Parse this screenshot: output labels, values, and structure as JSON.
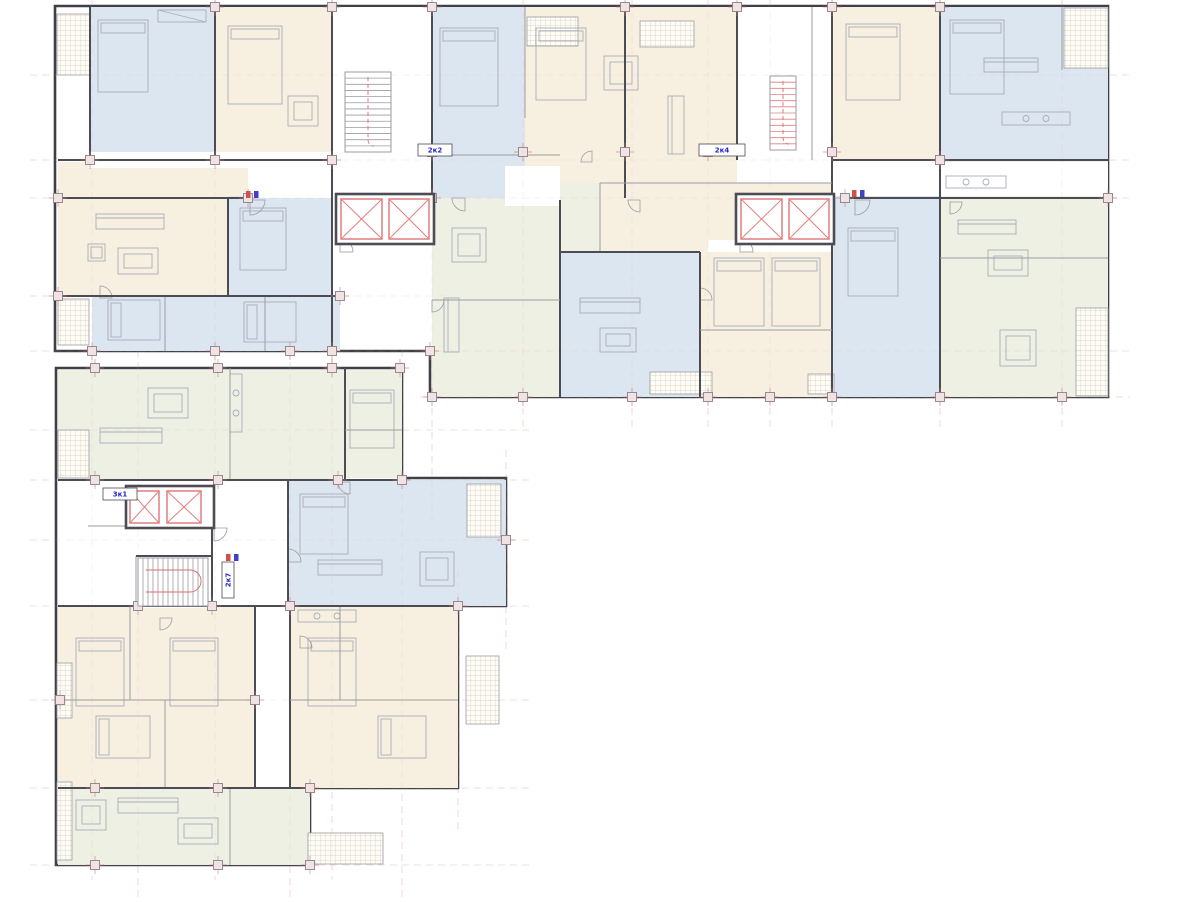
{
  "document": {
    "type": "architectural-floor-plan",
    "description": "Residential building floor plan, L-shaped, two wings with apartments, elevator cores and stairwells"
  },
  "palette": {
    "background": "#ffffff",
    "blue": "#dce6f0",
    "cream": "#f7f0e1",
    "green": "#edf0e3",
    "wall_dark": "#4c4c55",
    "wall_light": "#9b9ba3",
    "outline": "#3f3f47",
    "red_accent": "#e07f7f",
    "red_line": "#d96a6a",
    "column_fill": "#f2e2e2",
    "grid_pink": "#dba8a8",
    "hatch_line": "#d6ccb4",
    "furniture_line": "#a9adb8",
    "label_blue": "#2525cf",
    "meter_red": "#d05050",
    "meter_blue": "#4040c8"
  },
  "labels": [
    {
      "text": "2к2",
      "x": 418,
      "y": 144,
      "w": 34,
      "h": 12,
      "vertical": false
    },
    {
      "text": "2к4",
      "x": 699,
      "y": 144,
      "w": 46,
      "h": 12,
      "vertical": false
    },
    {
      "text": "3к1",
      "x": 103,
      "y": 488,
      "w": 34,
      "h": 12,
      "vertical": false
    },
    {
      "text": "2к7",
      "x": 222,
      "y": 562,
      "w": 12,
      "h": 36,
      "vertical": true
    }
  ],
  "footprints": [
    {
      "id": "upper-wing",
      "points": [
        [
          55,
          6
        ],
        [
          1108,
          6
        ],
        [
          1108,
          397
        ],
        [
          430,
          397
        ],
        [
          430,
          351
        ],
        [
          55,
          351
        ]
      ]
    },
    {
      "id": "lower-wing",
      "points": [
        [
          56,
          368
        ],
        [
          402,
          368
        ],
        [
          402,
          478
        ],
        [
          506,
          478
        ],
        [
          506,
          606
        ],
        [
          458,
          606
        ],
        [
          458,
          788
        ],
        [
          310,
          788
        ],
        [
          310,
          865
        ],
        [
          56,
          865
        ]
      ]
    }
  ],
  "zones": [
    [
      90,
      7,
      125,
      153,
      "blue"
    ],
    [
      215,
      7,
      117,
      153,
      "cream"
    ],
    [
      432,
      7,
      93,
      191,
      "blue"
    ],
    [
      525,
      7,
      100,
      191,
      "cream"
    ],
    [
      625,
      7,
      112,
      193,
      "cream"
    ],
    [
      832,
      7,
      108,
      153,
      "cream"
    ],
    [
      940,
      7,
      168,
      153,
      "blue"
    ],
    [
      58,
      162,
      230,
      134,
      "cream"
    ],
    [
      92,
      296,
      248,
      55,
      "blue"
    ],
    [
      228,
      196,
      104,
      100,
      "blue"
    ],
    [
      432,
      198,
      128,
      199,
      "green"
    ],
    [
      600,
      183,
      108,
      69,
      "cream"
    ],
    [
      708,
      183,
      124,
      57,
      "cream"
    ],
    [
      560,
      183,
      40,
      69,
      "green"
    ],
    [
      560,
      252,
      140,
      145,
      "blue"
    ],
    [
      700,
      252,
      132,
      145,
      "cream"
    ],
    [
      832,
      196,
      108,
      201,
      "blue"
    ],
    [
      940,
      160,
      168,
      237,
      "green"
    ],
    [
      58,
      370,
      287,
      110,
      "green"
    ],
    [
      345,
      370,
      57,
      108,
      "green"
    ],
    [
      288,
      480,
      218,
      126,
      "blue"
    ],
    [
      58,
      606,
      197,
      182,
      "cream"
    ],
    [
      290,
      606,
      168,
      182,
      "cream"
    ],
    [
      58,
      788,
      252,
      77,
      "green"
    ]
  ],
  "whites": [
    [
      88,
      152,
      250,
      16
    ],
    [
      248,
      156,
      184,
      42
    ],
    [
      845,
      162,
      263,
      34
    ],
    [
      737,
      7,
      95,
      153
    ],
    [
      333,
      7,
      99,
      189
    ],
    [
      505,
      166,
      55,
      40
    ],
    [
      88,
      482,
      44,
      44
    ],
    [
      90,
      526,
      198,
      80
    ],
    [
      214,
      480,
      74,
      46
    ],
    [
      136,
      554,
      76,
      54
    ]
  ],
  "balconies": [
    [
      57,
      14,
      33,
      61
    ],
    [
      1064,
      8,
      44,
      60
    ],
    [
      1076,
      308,
      32,
      88
    ],
    [
      650,
      372,
      62,
      22
    ],
    [
      808,
      374,
      26,
      20
    ],
    [
      58,
      299,
      31,
      46
    ],
    [
      58,
      430,
      31,
      48
    ],
    [
      467,
      484,
      34,
      53
    ],
    [
      466,
      656,
      33,
      68
    ],
    [
      308,
      833,
      75,
      31
    ],
    [
      57,
      663,
      15,
      55
    ],
    [
      57,
      782,
      15,
      78
    ],
    [
      527,
      17,
      51,
      29
    ],
    [
      640,
      21,
      54,
      26
    ]
  ],
  "walls": [
    [
      90,
      7,
      90,
      160,
      2
    ],
    [
      215,
      7,
      215,
      160,
      2
    ],
    [
      332,
      7,
      332,
      198,
      2
    ],
    [
      432,
      7,
      432,
      198,
      2
    ],
    [
      525,
      7,
      525,
      118,
      1
    ],
    [
      625,
      7,
      625,
      198,
      2
    ],
    [
      737,
      7,
      737,
      160,
      2
    ],
    [
      812,
      7,
      812,
      160,
      1
    ],
    [
      832,
      7,
      832,
      198,
      2
    ],
    [
      940,
      7,
      940,
      160,
      2
    ],
    [
      1062,
      7,
      1062,
      70,
      1
    ],
    [
      228,
      198,
      228,
      296,
      2
    ],
    [
      332,
      198,
      332,
      351,
      2
    ],
    [
      560,
      200,
      560,
      397,
      2
    ],
    [
      600,
      183,
      600,
      252,
      1
    ],
    [
      700,
      252,
      700,
      397,
      2
    ],
    [
      832,
      198,
      832,
      397,
      2
    ],
    [
      940,
      160,
      940,
      397,
      2
    ],
    [
      165,
      296,
      165,
      351,
      1
    ],
    [
      265,
      296,
      265,
      351,
      1
    ],
    [
      58,
      160,
      332,
      160,
      2
    ],
    [
      432,
      155,
      560,
      155,
      1
    ],
    [
      832,
      160,
      1108,
      160,
      2
    ],
    [
      58,
      198,
      248,
      198,
      2
    ],
    [
      845,
      198,
      1108,
      198,
      2
    ],
    [
      58,
      296,
      340,
      296,
      2
    ],
    [
      560,
      252,
      700,
      252,
      2
    ],
    [
      600,
      183,
      832,
      183,
      1
    ],
    [
      700,
      330,
      832,
      330,
      1
    ],
    [
      940,
      258,
      1108,
      258,
      1
    ],
    [
      432,
      300,
      560,
      300,
      1
    ],
    [
      345,
      368,
      345,
      480,
      2
    ],
    [
      288,
      480,
      288,
      606,
      2
    ],
    [
      214,
      480,
      214,
      526,
      2
    ],
    [
      212,
      526,
      212,
      608,
      2
    ],
    [
      136,
      556,
      136,
      608,
      1
    ],
    [
      255,
      606,
      255,
      788,
      2
    ],
    [
      290,
      606,
      290,
      788,
      2
    ],
    [
      130,
      606,
      130,
      700,
      1
    ],
    [
      165,
      700,
      165,
      788,
      1
    ],
    [
      340,
      606,
      340,
      700,
      1
    ],
    [
      230,
      788,
      230,
      865,
      1
    ],
    [
      230,
      368,
      230,
      480,
      1
    ],
    [
      58,
      480,
      402,
      480,
      2
    ],
    [
      88,
      526,
      214,
      526,
      1
    ],
    [
      136,
      556,
      212,
      556,
      2
    ],
    [
      58,
      606,
      458,
      606,
      2
    ],
    [
      58,
      700,
      255,
      700,
      1
    ],
    [
      290,
      700,
      458,
      700,
      1
    ],
    [
      58,
      788,
      310,
      788,
      2
    ],
    [
      345,
      430,
      402,
      430,
      1
    ]
  ],
  "columns": [
    [
      90,
      160
    ],
    [
      215,
      160
    ],
    [
      332,
      160
    ],
    [
      432,
      152
    ],
    [
      523,
      152
    ],
    [
      625,
      152
    ],
    [
      708,
      152
    ],
    [
      832,
      152
    ],
    [
      940,
      160
    ],
    [
      58,
      198
    ],
    [
      248,
      198
    ],
    [
      432,
      198
    ],
    [
      845,
      198
    ],
    [
      1108,
      198
    ],
    [
      58,
      296
    ],
    [
      340,
      296
    ],
    [
      92,
      351
    ],
    [
      215,
      351
    ],
    [
      290,
      351
    ],
    [
      332,
      351
    ],
    [
      430,
      351
    ],
    [
      432,
      397
    ],
    [
      523,
      397
    ],
    [
      632,
      397
    ],
    [
      708,
      397
    ],
    [
      770,
      397
    ],
    [
      832,
      397
    ],
    [
      940,
      397
    ],
    [
      1062,
      397
    ],
    [
      215,
      7
    ],
    [
      332,
      7
    ],
    [
      432,
      7
    ],
    [
      625,
      7
    ],
    [
      737,
      7
    ],
    [
      832,
      7
    ],
    [
      940,
      7
    ],
    [
      95,
      368
    ],
    [
      218,
      368
    ],
    [
      332,
      368
    ],
    [
      400,
      368
    ],
    [
      95,
      480
    ],
    [
      218,
      480
    ],
    [
      338,
      480
    ],
    [
      402,
      480
    ],
    [
      138,
      606
    ],
    [
      212,
      606
    ],
    [
      290,
      606
    ],
    [
      458,
      606
    ],
    [
      60,
      700
    ],
    [
      255,
      700
    ],
    [
      95,
      788
    ],
    [
      218,
      788
    ],
    [
      310,
      788
    ],
    [
      95,
      865
    ],
    [
      218,
      865
    ],
    [
      310,
      865
    ],
    [
      506,
      540
    ]
  ],
  "grid_v": [
    [
      92,
      0,
      880
    ],
    [
      215,
      0,
      880
    ],
    [
      332,
      0,
      880
    ],
    [
      432,
      0,
      520
    ],
    [
      523,
      0,
      430
    ],
    [
      632,
      0,
      430
    ],
    [
      708,
      0,
      430
    ],
    [
      770,
      0,
      430
    ],
    [
      832,
      0,
      430
    ],
    [
      940,
      0,
      430
    ],
    [
      1062,
      0,
      430
    ],
    [
      138,
      350,
      900
    ],
    [
      290,
      350,
      900
    ],
    [
      402,
      350,
      900
    ],
    [
      458,
      570,
      830
    ],
    [
      506,
      450,
      650
    ]
  ],
  "grid_h": [
    [
      30,
      75,
      1130
    ],
    [
      30,
      160,
      1130
    ],
    [
      30,
      198,
      1130
    ],
    [
      30,
      296,
      450
    ],
    [
      30,
      351,
      1130
    ],
    [
      420,
      397,
      1130
    ],
    [
      30,
      430,
      530
    ],
    [
      30,
      480,
      530
    ],
    [
      30,
      540,
      530
    ],
    [
      30,
      606,
      530
    ],
    [
      30,
      700,
      530
    ],
    [
      30,
      788,
      530
    ],
    [
      30,
      865,
      530
    ]
  ],
  "elevator_cores": [
    {
      "shell": [
        336,
        194,
        98,
        50
      ],
      "cars": [
        [
          341,
          199,
          41,
          40
        ],
        [
          389,
          199,
          40,
          40
        ]
      ]
    },
    {
      "shell": [
        736,
        194,
        98,
        50
      ],
      "cars": [
        [
          741,
          199,
          41,
          40
        ],
        [
          789,
          199,
          40,
          40
        ]
      ]
    },
    {
      "shell": [
        126,
        486,
        88,
        42
      ],
      "cars": [
        [
          130,
          491,
          29,
          32
        ],
        [
          167,
          491,
          34,
          32
        ]
      ]
    }
  ],
  "stairs": [
    {
      "x": 345,
      "y": 72,
      "w": 46,
      "h": 80,
      "dir": "v",
      "steps": 13,
      "red": false
    },
    {
      "x": 770,
      "y": 76,
      "w": 26,
      "h": 74,
      "dir": "v",
      "steps": 12,
      "red": true
    },
    {
      "x": 138,
      "y": 558,
      "w": 70,
      "h": 48,
      "dir": "h",
      "steps": 14,
      "red": false
    }
  ],
  "doors": [
    [
      250,
      200,
      15,
      0
    ],
    [
      340,
      252,
      13,
      3
    ],
    [
      465,
      198,
      13,
      1
    ],
    [
      855,
      200,
      15,
      0
    ],
    [
      740,
      252,
      13,
      3
    ],
    [
      214,
      528,
      13,
      0
    ],
    [
      288,
      562,
      13,
      3
    ],
    [
      160,
      618,
      12,
      0
    ],
    [
      300,
      648,
      12,
      3
    ],
    [
      640,
      200,
      12,
      1
    ],
    [
      950,
      202,
      12,
      0
    ],
    [
      350,
      482,
      12,
      1
    ],
    [
      100,
      298,
      12,
      3
    ],
    [
      592,
      162,
      11,
      2
    ],
    [
      432,
      300,
      12,
      0
    ],
    [
      700,
      300,
      12,
      3
    ]
  ],
  "furniture": [
    [
      "bed",
      98,
      20,
      50,
      72
    ],
    [
      "ward",
      158,
      10,
      48,
      12
    ],
    [
      "bed",
      228,
      26,
      54,
      78
    ],
    [
      "table",
      288,
      96,
      30,
      30
    ],
    [
      "bed",
      440,
      28,
      58,
      78
    ],
    [
      "bed",
      536,
      28,
      50,
      72
    ],
    [
      "table",
      604,
      56,
      34,
      34
    ],
    [
      "sofa",
      668,
      96,
      16,
      58
    ],
    [
      "bed",
      846,
      24,
      54,
      76
    ],
    [
      "bed",
      950,
      20,
      54,
      74
    ],
    [
      "sofa",
      984,
      58,
      54,
      14
    ],
    [
      "kitchen",
      1002,
      112,
      68,
      13
    ],
    [
      "sofa",
      96,
      214,
      68,
      15
    ],
    [
      "table",
      118,
      248,
      40,
      26
    ],
    [
      "arm",
      88,
      244,
      17,
      17
    ],
    [
      "bed",
      108,
      300,
      52,
      40
    ],
    [
      "bed",
      244,
      302,
      52,
      40
    ],
    [
      "bed",
      240,
      208,
      46,
      62
    ],
    [
      "table",
      452,
      228,
      34,
      34
    ],
    [
      "sofa",
      444,
      298,
      15,
      54
    ],
    [
      "sofa",
      580,
      298,
      60,
      15
    ],
    [
      "table",
      600,
      328,
      36,
      24
    ],
    [
      "bed",
      714,
      258,
      50,
      68
    ],
    [
      "bed",
      772,
      258,
      48,
      68
    ],
    [
      "bed",
      848,
      228,
      50,
      68
    ],
    [
      "kitchen",
      946,
      176,
      60,
      12
    ],
    [
      "sofa",
      958,
      220,
      58,
      14
    ],
    [
      "table",
      988,
      250,
      40,
      26
    ],
    [
      "table",
      1000,
      330,
      36,
      36
    ],
    [
      "table",
      148,
      388,
      40,
      30
    ],
    [
      "sofa",
      100,
      428,
      62,
      15
    ],
    [
      "kitchen",
      230,
      374,
      12,
      58
    ],
    [
      "bed",
      350,
      390,
      44,
      58
    ],
    [
      "bed",
      300,
      494,
      48,
      60
    ],
    [
      "sofa",
      318,
      560,
      64,
      15
    ],
    [
      "table",
      420,
      552,
      34,
      34
    ],
    [
      "bed",
      76,
      638,
      48,
      68
    ],
    [
      "bed",
      170,
      638,
      48,
      68
    ],
    [
      "bed",
      96,
      716,
      54,
      42
    ],
    [
      "kitchen",
      298,
      610,
      58,
      12
    ],
    [
      "bed",
      308,
      638,
      48,
      68
    ],
    [
      "bed",
      378,
      716,
      48,
      42
    ],
    [
      "sofa",
      118,
      798,
      60,
      15
    ],
    [
      "table",
      178,
      818,
      40,
      26
    ],
    [
      "table",
      76,
      800,
      30,
      30
    ]
  ],
  "meters": [
    [
      246,
      191
    ],
    [
      852,
      190
    ],
    [
      226,
      554
    ]
  ]
}
